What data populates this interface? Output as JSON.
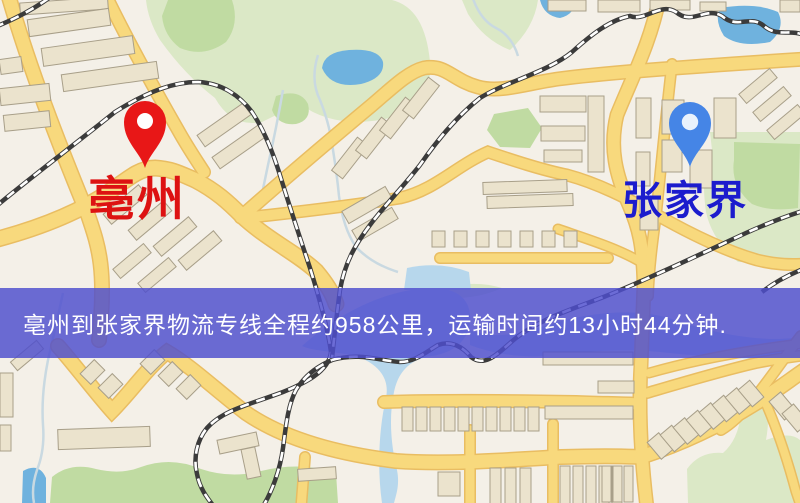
{
  "banner": {
    "text": "亳州到张家界物流专线全程约958公里，运输时间约13小时44分钟.",
    "bg_color": "rgba(78,78,206,0.83)",
    "text_color": "#ffffff",
    "distance_km": "958",
    "duration_text": "13小时44分钟"
  },
  "markers": {
    "origin": {
      "label": "亳州",
      "pin_icon": "red-map-pin",
      "pin_color": "#e81717",
      "pin_inner_color": "#ffffff",
      "label_color": "#dd1212"
    },
    "destination": {
      "label": "张家界",
      "pin_icon": "blue-map-pin",
      "pin_color": "#4585e6",
      "pin_inner_color": "#e9f2fc",
      "label_color": "#1c1ccd"
    }
  },
  "map_colors": {
    "background": "#f4f0e8",
    "road_fill": "#f8d97d",
    "road_casing": "#e9bd62",
    "railway_dark": "#3b3b3b",
    "railway_dash": "#ffffff",
    "water_lake": "#6fb2de",
    "water_light": "#b7d7ec",
    "river_line": "#c9d9e1",
    "park_pale": "#dbe8c6",
    "park_green": "#c0dba2",
    "building_fill": "#ebe3cd",
    "building_outline": "#a89f89"
  }
}
